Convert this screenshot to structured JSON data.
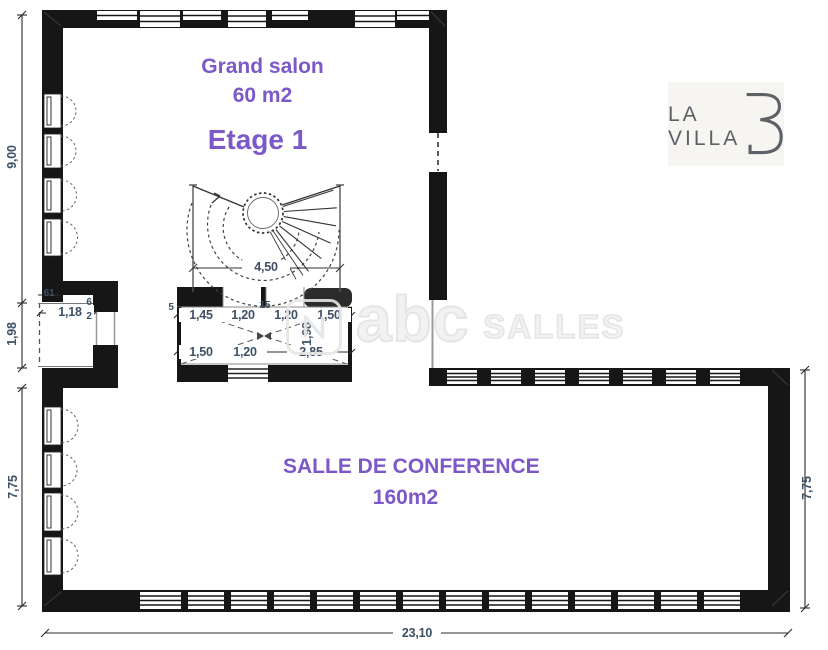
{
  "floor": {
    "label": "Etage 1"
  },
  "rooms": {
    "salon": {
      "name": "Grand salon",
      "area": "60 m2"
    },
    "conference": {
      "name": "SALLE DE CONFERENCE",
      "area": "160m2"
    }
  },
  "logo": {
    "line1": "LA",
    "line2": "VILLA",
    "letter": "B"
  },
  "watermark": {
    "main": "abc",
    "suffix": "SALLES"
  },
  "dims": {
    "left_height_top": "9,00",
    "left_terrace_height": "1,98",
    "left_height_bottom": "7,75",
    "right_height": "7,75",
    "total_width": "23,10",
    "stair_width": "4,50",
    "terrace_top": "61",
    "terrace_width": "1,18",
    "terrace_small_a": "6",
    "terrace_small_b": "2",
    "shaft_small_left": "5",
    "shaft_top": [
      "1,45",
      "1,20",
      "15",
      "1,20",
      "1,50"
    ],
    "shaft_height": "1,98",
    "shaft_bottom": [
      "1,50",
      "1,20",
      "2,85"
    ]
  },
  "colors": {
    "accent_purple": "#7c58c8",
    "dimension_text": "#3d5166",
    "wall": "#161616",
    "watermark_gray": "#e3e3e3"
  }
}
